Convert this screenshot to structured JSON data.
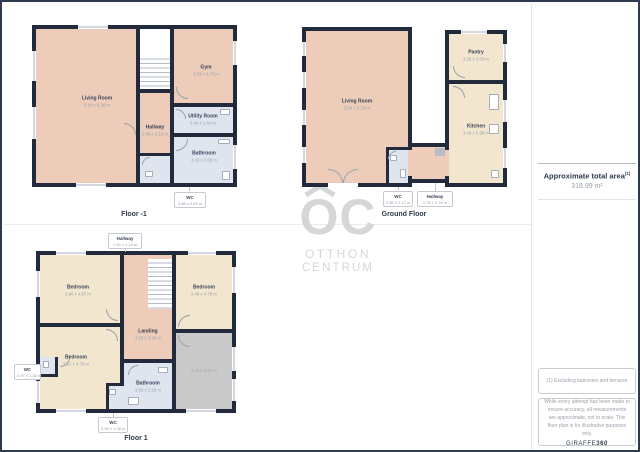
{
  "floors": [
    {
      "id": "floor-minus-1",
      "label": "Floor -1",
      "rooms": [
        {
          "name": "Living Room",
          "dims": "5.84 x 6.39 m"
        },
        {
          "name": "Gym",
          "dims": "3.04 x 4.73 m"
        },
        {
          "name": "Hallway",
          "dims": "2.99 x 3.18 m"
        },
        {
          "name": "Utility Room",
          "dims": "3.44 x 1.64 m"
        },
        {
          "name": "Bathroom",
          "dims": "3.42 x 3.09 m"
        },
        {
          "name": "WC",
          "dims": "0.85 x 0.85 m"
        }
      ]
    },
    {
      "id": "ground-floor",
      "label": "Ground Floor",
      "rooms": [
        {
          "name": "Living Room",
          "dims": "5.54 x 5.73 m"
        },
        {
          "name": "Pantry",
          "dims": "3.26 x 3.03 m"
        },
        {
          "name": "Kitchen",
          "dims": "3.44 x 5.58 m"
        },
        {
          "name": "WC",
          "dims": "0.85 x 2.12 m"
        },
        {
          "name": "Hallway",
          "dims": "1.78 x 2.78 m"
        }
      ]
    },
    {
      "id": "floor-1",
      "label": "Floor 1",
      "rooms": [
        {
          "name": "Hallway",
          "dims": "1.09 x 1.14 m"
        },
        {
          "name": "Bedroom",
          "dims": "3.96 x 4.87 m"
        },
        {
          "name": "Bedroom",
          "dims": "3.48 x 4.79 m"
        },
        {
          "name": "Landing",
          "dims": "4.56 x 3.80 m"
        },
        {
          "name": "Bedroom",
          "dims": "3.62 x 4.79 m"
        },
        {
          "name": "Bathroom",
          "dims": "3.39 x 2.58 m"
        },
        {
          "name": "",
          "dims": "3.44 x 4.81 m"
        },
        {
          "name": "WC",
          "dims": "0.97 x 1.38 m"
        },
        {
          "name": "WC",
          "dims": "0.95 x 1.38 m"
        }
      ]
    }
  ],
  "logo": {
    "monogram": "OC",
    "line1": "OTTHON",
    "line2": "CENTRUM"
  },
  "info": {
    "total_area_title": "Approximate total area",
    "total_area_sup": "(1)",
    "total_area_value": "318.99 m²",
    "footnote": "(1) Excluding balconies and terraces",
    "disclaimer": "While every attempt has been made to ensure accuracy, all measurements are approximate, not to scale. This floor plan is for illustrative purposes only.",
    "brand_name": "GIRAFFE",
    "brand_suffix": "360"
  },
  "colors": {
    "wall": "#212b3c",
    "room_warm": "#edcdba",
    "room_cream": "#f2e6cf",
    "room_wet": "#dfe5ee",
    "room_excluded": "#c9c9c9",
    "text_dark": "#2e3a4d",
    "text_muted": "#9aa1ab",
    "watermark": "#d4d6d8"
  }
}
